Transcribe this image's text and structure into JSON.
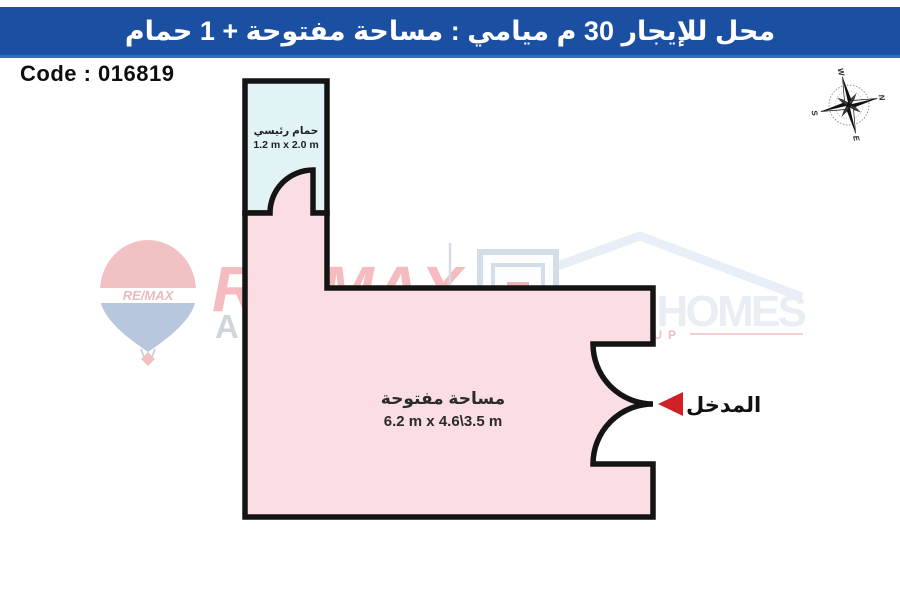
{
  "header": {
    "title": "محل للإيجار 30 م ميامي : مساحة مفتوحة + 1 حمام"
  },
  "code": {
    "label": "Code : 016819"
  },
  "floor_plan": {
    "open_area": {
      "name": "مساحة مفتوحة",
      "dimensions": "6.2 m x 4.6\\3.5 m"
    },
    "bathroom": {
      "name": "حمام رئيسي",
      "dimensions": "1.2 m x 2.0 m"
    },
    "entrance": {
      "label": "المدخل"
    }
  },
  "compass": {
    "north": "N",
    "east": "E",
    "south": "S",
    "west": "W"
  },
  "watermarks": {
    "remax": {
      "re": "RE",
      "slash": "/",
      "max": "MAX",
      "brand_sub": "AVALON",
      "balloon_text": "RE/MAX"
    },
    "new_homes": {
      "word1": "NEW",
      "word2": "HOMES",
      "sub": "GROUP"
    }
  },
  "colors": {
    "header_bar": "#1a4fa1",
    "header_border": "#2e6ec5",
    "open_area_fill": "#fadee3",
    "bathroom_fill": "#e2f3f5",
    "wall": "#141414",
    "entrance_arrow": "#cf2127",
    "remax_red": "#e2333f",
    "newhomes_blue": "#e9eef6"
  }
}
